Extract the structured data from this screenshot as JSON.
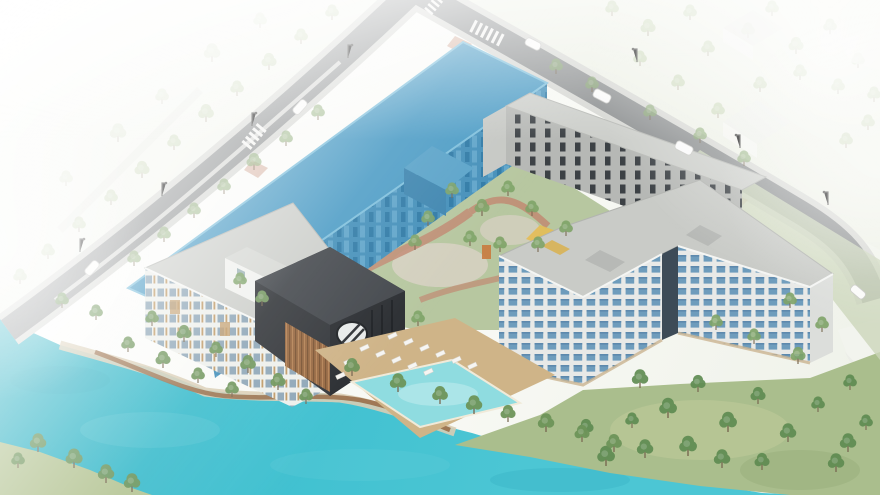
{
  "meta": {
    "title": "Aerial architectural site rendering",
    "type": "isometric-architectural-rendering",
    "scene_summary": "Bird's-eye architectural visualization of a lakeside residential development: a long site massing highlighted in blue along the upper street, a large L-shaped apartment building with blue glazed facades, a five-storey white residential block, a dark charcoal clubhouse with a round window, an outdoor pool with sun loungers, landscaped courtyard with play area, turquoise lake with timber boardwalk, perimeter roads with crosswalks, cars, street lights and trees fading to white at the image edges."
  },
  "elements": [
    {
      "name": "lake",
      "label": "Turquoise lake with boardwalk promenade"
    },
    {
      "name": "highlighted-building",
      "label": "Development massing highlighted in blue"
    },
    {
      "name": "main-apartment-building",
      "label": "L-shaped apartment building with window grid"
    },
    {
      "name": "west-residential-building",
      "label": "Five-storey white residential building"
    },
    {
      "name": "amenity-building",
      "label": "Dark clubhouse with circular window"
    },
    {
      "name": "townhouse-row",
      "label": "Grey townhouse row along upper street"
    },
    {
      "name": "pool-area",
      "label": "Outdoor pool with white sun loungers"
    },
    {
      "name": "courtyard",
      "label": "Landscaped courtyard with red paths and playground"
    },
    {
      "name": "roads",
      "label": "Perimeter streets with crosswalks, cars and street lights"
    },
    {
      "name": "context",
      "label": "Faded context houses and tree landscape"
    }
  ],
  "colors": {
    "background": "#ffffff",
    "lake": "#3fc0d0",
    "lake_deep": "#2fb2c4",
    "lake_shallow": "#6fd0da",
    "pool": "#8fdce0",
    "pool_deck": "#cfb488",
    "boardwalk": "#9a6f4a",
    "road": "#8e9192",
    "sidewalk": "#d7d8d4",
    "crosswalk": "#f4f4f2",
    "lawn_green": "#aabe8d",
    "courtyard_green": "#b7c7a0",
    "path_red": "#c18a72",
    "path_light": "#d9d2c5",
    "playground_yellow": "#e4bd55",
    "accent_orange": "#c97a3e",
    "highlight_roof": "#4e9dc6",
    "highlight_facade": "#4590ba",
    "highlight_window": "#2f7aa6",
    "main_facade": "#e8e9e7",
    "main_window": "#6e9cbc",
    "main_roof": "#c9cbc7",
    "glass_core": "#3d4b57",
    "west_facade": "#eef0ec",
    "west_window": "#8fa7b8",
    "wood": "#b9905e",
    "dark_building": "#35383c",
    "dark_building_roof": "#44484d",
    "townhouse_facade": "#b6b8b5",
    "townhouse_window": "#3c4145",
    "townhouse_roof": "#cdcfcb",
    "context_white": "#f3f3f0",
    "tree_green": "#7fa468",
    "tree_dark": "#5f8b52",
    "tree_faded": "#9db77f",
    "trunk": "#7a6a52",
    "car_white": "#fbfbfa",
    "chair_white": "#f6f5f2"
  }
}
